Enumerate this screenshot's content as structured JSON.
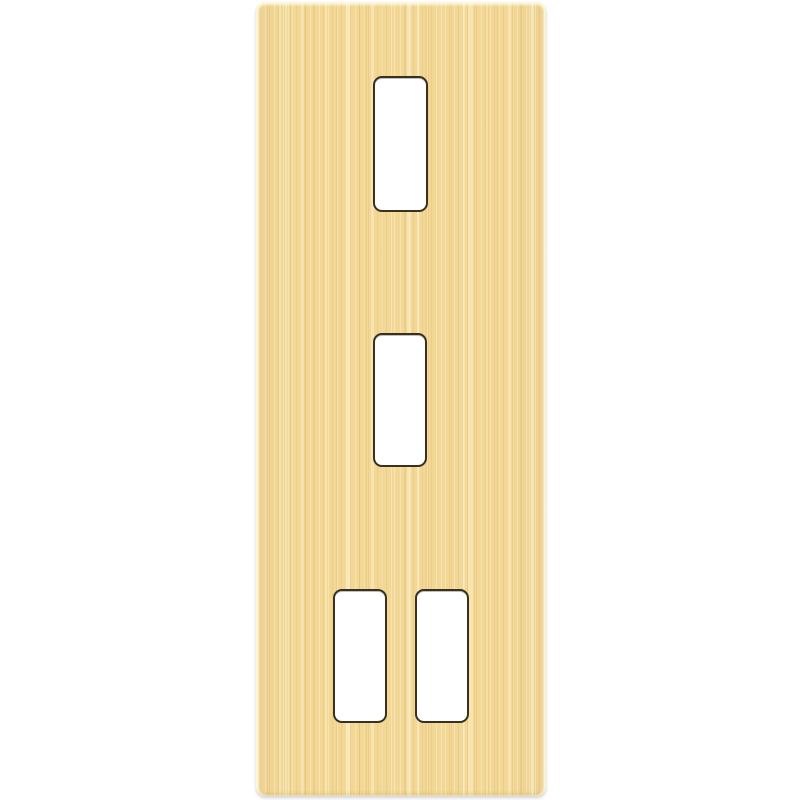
{
  "scene": {
    "description": "Brushed satin gold vertical grid wall plate with four rectangular module cutouts, photographed on a plain white background",
    "background_color": "#ffffff",
    "plate": {
      "finish": "brushed gold",
      "base_color": "#f3d795",
      "highlight_streak_color": "#faeec9",
      "dark_streak_color": "#e6c177",
      "edge_highlight_color": "#fdf3d5",
      "cutout_outline_color": "#3a3020",
      "cutout_fill_color": "#ffffff",
      "cutout_count": 4
    },
    "cutouts": [
      {
        "id": "top",
        "position": "upper center"
      },
      {
        "id": "middle",
        "position": "middle center"
      },
      {
        "id": "bottom-left",
        "position": "lower left"
      },
      {
        "id": "bottom-right",
        "position": "lower right"
      }
    ]
  }
}
